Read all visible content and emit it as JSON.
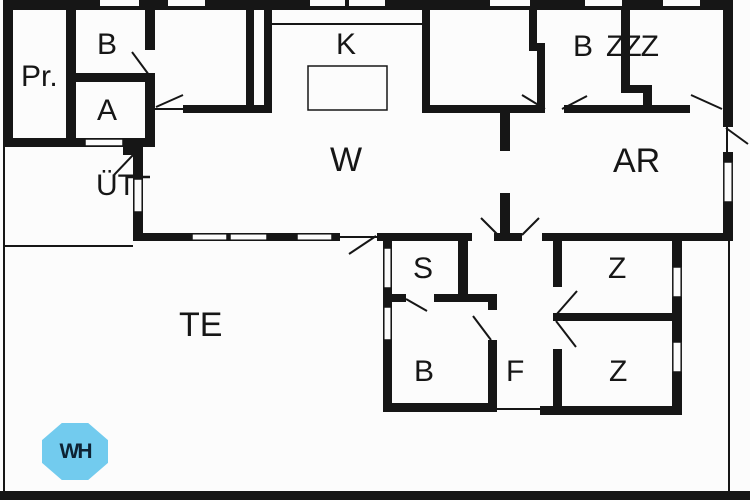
{
  "title": "floor-plan",
  "rooms": {
    "pr": "Pr.",
    "b_top_left": "B",
    "a": "A",
    "k": "K",
    "b_top_right": "B",
    "zzz": "ZZZ",
    "w": "W",
    "uet": "ÜT",
    "ar": "AR",
    "te": "TE",
    "s": "S",
    "z_upper": "Z",
    "b_bottom": "B",
    "f": "F",
    "z_lower": "Z"
  },
  "badge": {
    "label": "WH"
  },
  "colors": {
    "wall": "#161616",
    "background": "#fcfcfc",
    "badge_fill": "#72cbee",
    "badge_text": "#0d2233"
  }
}
